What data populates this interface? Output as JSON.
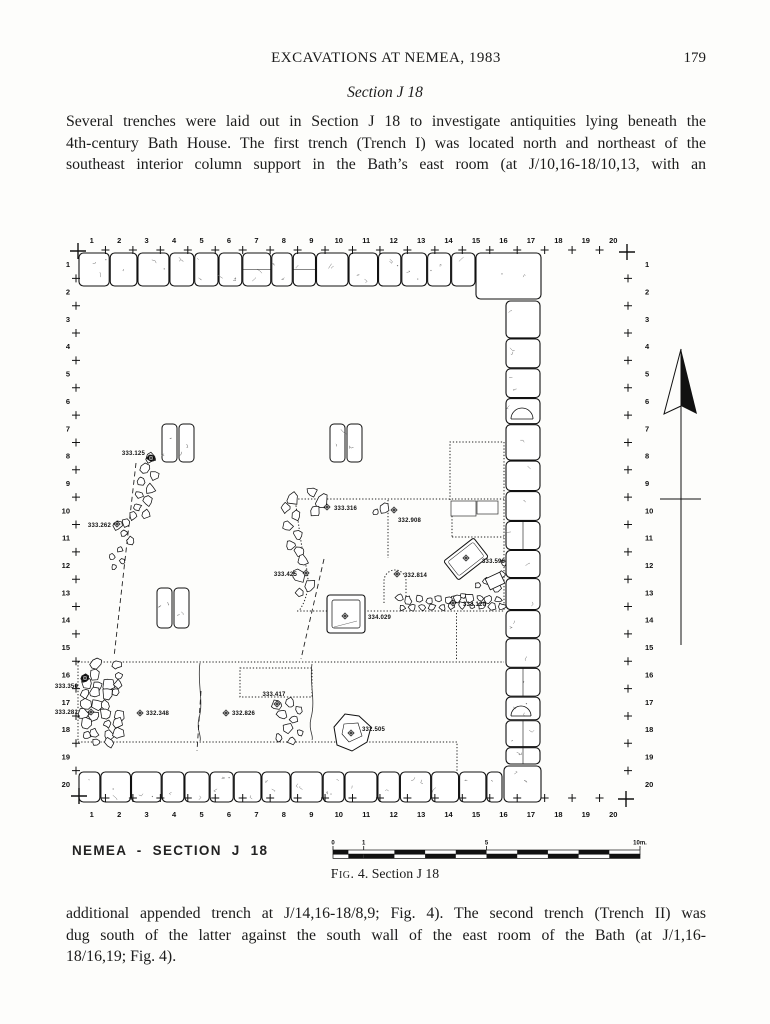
{
  "header": {
    "title": "EXCAVATIONS AT NEMEA, 1983",
    "page_number": "179"
  },
  "section_heading": "Section J 18",
  "paragraph_top": {
    "lines": [
      "Several trenches were laid out in Section J 18 to investigate antiquities lying beneath the",
      "4th-century Bath House. The first trench (Trench I) was located north and northeast of the",
      "southeast interior column support in the Bath’s east room (at J/10,16-18/10,13, with an"
    ]
  },
  "paragraph_bottom": {
    "lines": [
      "additional appended trench at J/14,16-18/8,9; Fig. 4). The second trench (Trench II) was",
      "dug south of the latter against the south wall of the east room of the Bath (at J/1,16-",
      "18/16,19; Fig. 4)."
    ]
  },
  "figure": {
    "plan_title": "NEMEA - SECTION J 18",
    "caption_label": "Fig.",
    "caption_rest": " 4. Section J 18",
    "grid_labels": [
      "1",
      "2",
      "3",
      "4",
      "5",
      "6",
      "7",
      "8",
      "9",
      "10",
      "11",
      "12",
      "13",
      "14",
      "15",
      "16",
      "17",
      "18",
      "19",
      "20"
    ],
    "scale_bar": {
      "ticks": [
        {
          "label": "0",
          "m": 0
        },
        {
          "label": "1",
          "m": 1
        },
        {
          "label": "5",
          "m": 5
        },
        {
          "label": "10m.",
          "m": 10
        }
      ]
    },
    "elevation_points": [
      {
        "label": "333.125",
        "x": 151,
        "y": 458,
        "lx": 145,
        "ly": 455,
        "anchor": "end",
        "dark": true
      },
      {
        "label": "333.262",
        "x": 117,
        "y": 524,
        "lx": 111,
        "ly": 527,
        "anchor": "end"
      },
      {
        "label": "333.316",
        "x": 327,
        "y": 507,
        "lx": 334,
        "ly": 510,
        "anchor": "start"
      },
      {
        "label": "332.908",
        "x": 394,
        "y": 510,
        "lx": 398,
        "ly": 522,
        "anchor": "start"
      },
      {
        "label": "333.425",
        "x": 306,
        "y": 573,
        "lx": 297,
        "ly": 576,
        "anchor": "end"
      },
      {
        "label": "332.814",
        "x": 397,
        "y": 574,
        "lx": 404,
        "ly": 577,
        "anchor": "start"
      },
      {
        "label": "333.598",
        "x": 466,
        "y": 558,
        "lx": 482,
        "ly": 563,
        "anchor": "start"
      },
      {
        "label": "333.120",
        "x": 453,
        "y": 603,
        "lx": 463,
        "ly": 606,
        "anchor": "start"
      },
      {
        "label": "334.029",
        "x": 345,
        "y": 616,
        "lx": 368,
        "ly": 619,
        "anchor": "start"
      },
      {
        "label": "333.350",
        "x": 85,
        "y": 678,
        "lx": 78,
        "ly": 688,
        "anchor": "end",
        "dark": true
      },
      {
        "label": "333.281",
        "x": 91,
        "y": 712,
        "lx": 78,
        "ly": 714,
        "anchor": "end"
      },
      {
        "label": "332.348",
        "x": 140,
        "y": 713,
        "lx": 146,
        "ly": 715,
        "anchor": "start"
      },
      {
        "label": "332.826",
        "x": 226,
        "y": 713,
        "lx": 232,
        "ly": 715,
        "anchor": "start"
      },
      {
        "label": "333.417",
        "x": 277,
        "y": 704,
        "lx": 274,
        "ly": 696,
        "anchor": "middle"
      },
      {
        "label": "332.505",
        "x": 351,
        "y": 733,
        "lx": 362,
        "ly": 731,
        "anchor": "start"
      }
    ]
  }
}
